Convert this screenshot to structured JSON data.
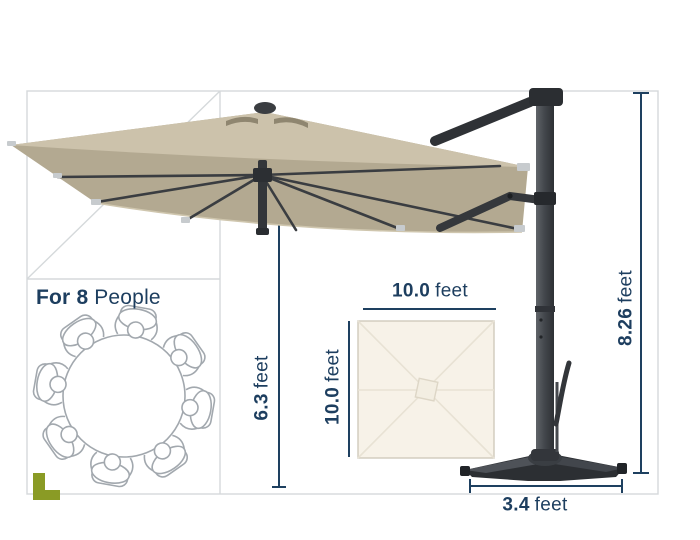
{
  "capacity": {
    "bold_part": "For 8",
    "regular_part": "People"
  },
  "dimensions": {
    "overall_height": {
      "value": "8.26",
      "unit": "feet"
    },
    "clearance_height": {
      "value": "6.3",
      "unit": "feet"
    },
    "canopy_width": {
      "value": "10.0",
      "unit": "feet"
    },
    "canopy_depth": {
      "value": "10.0",
      "unit": "feet"
    },
    "base_width": {
      "value": "3.4",
      "unit": "feet"
    }
  },
  "colors": {
    "annotation_navy": "#1d3e5f",
    "canopy_tan_top": "#ccc2ab",
    "canopy_tan_underside": "#b3a991",
    "frame_dark_gray": "#33363a",
    "guide_line_gray": "#d5d9db",
    "sketch_gray": "#a2a8ae",
    "topview_cream": "#f7f2e8",
    "corner_mark_green": "#8a9b25"
  },
  "illustrations": {
    "umbrella": "cantilever-patio-umbrella-side-view",
    "table": "round-table-with-8-seats-top-view",
    "canopy_topview": "square-canopy-top-view"
  }
}
